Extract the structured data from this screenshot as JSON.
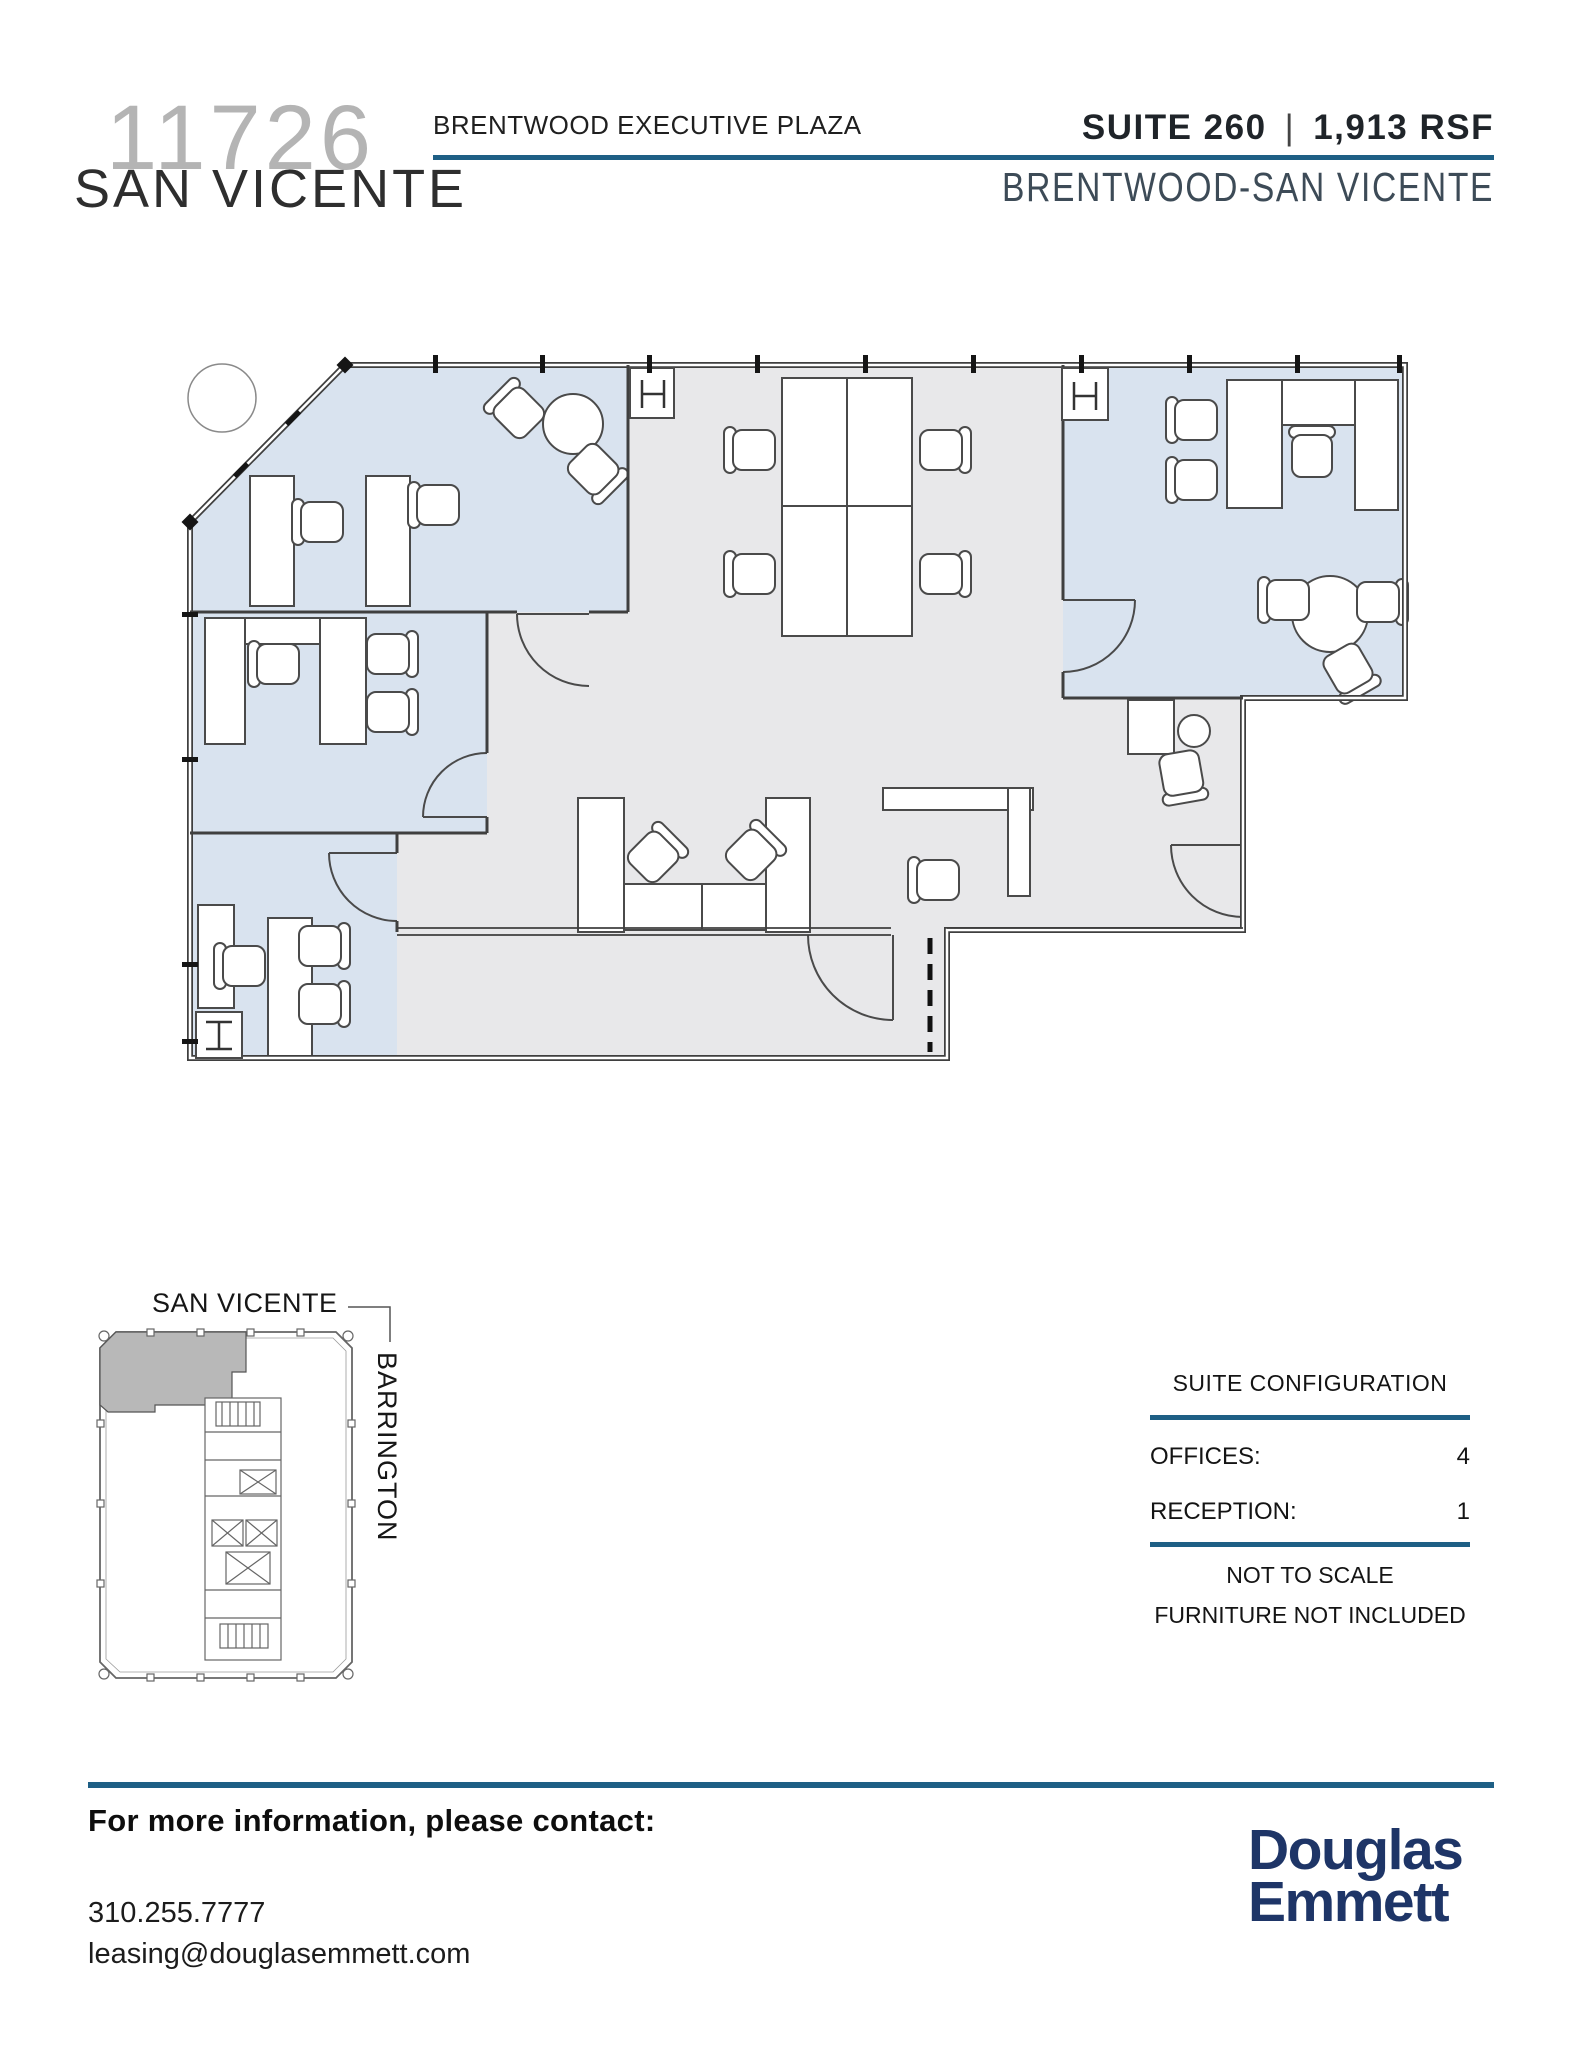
{
  "header": {
    "building_number": "11726",
    "building_street": "SAN VICENTE",
    "building_name": "BRENTWOOD EXECUTIVE PLAZA",
    "suite": "SUITE 260",
    "divider": "|",
    "area": "1,913 RSF",
    "submarket": "BRENTWOOD-SAN VICENTE"
  },
  "key_plan": {
    "street_top": "SAN VICENTE",
    "street_side": "BARRINGTON"
  },
  "suite_configuration": {
    "title": "SUITE CONFIGURATION",
    "rows": [
      {
        "label": "OFFICES:",
        "value": "4"
      },
      {
        "label": "RECEPTION:",
        "value": "1"
      }
    ],
    "notes": [
      "NOT TO SCALE",
      "FURNITURE NOT INCLUDED"
    ]
  },
  "footer": {
    "heading": "For more information, please contact:",
    "phone": "310.255.7777",
    "email": "leasing@douglasemmett.com",
    "logo": [
      "Douglas",
      "Emmett"
    ]
  },
  "colors": {
    "accent_rule": "#1e5f85",
    "logo_navy": "#1e3567",
    "office_fill": "#d9e3ef",
    "open_area_fill": "#e8e8ea",
    "wall": "#3f3f3f"
  }
}
